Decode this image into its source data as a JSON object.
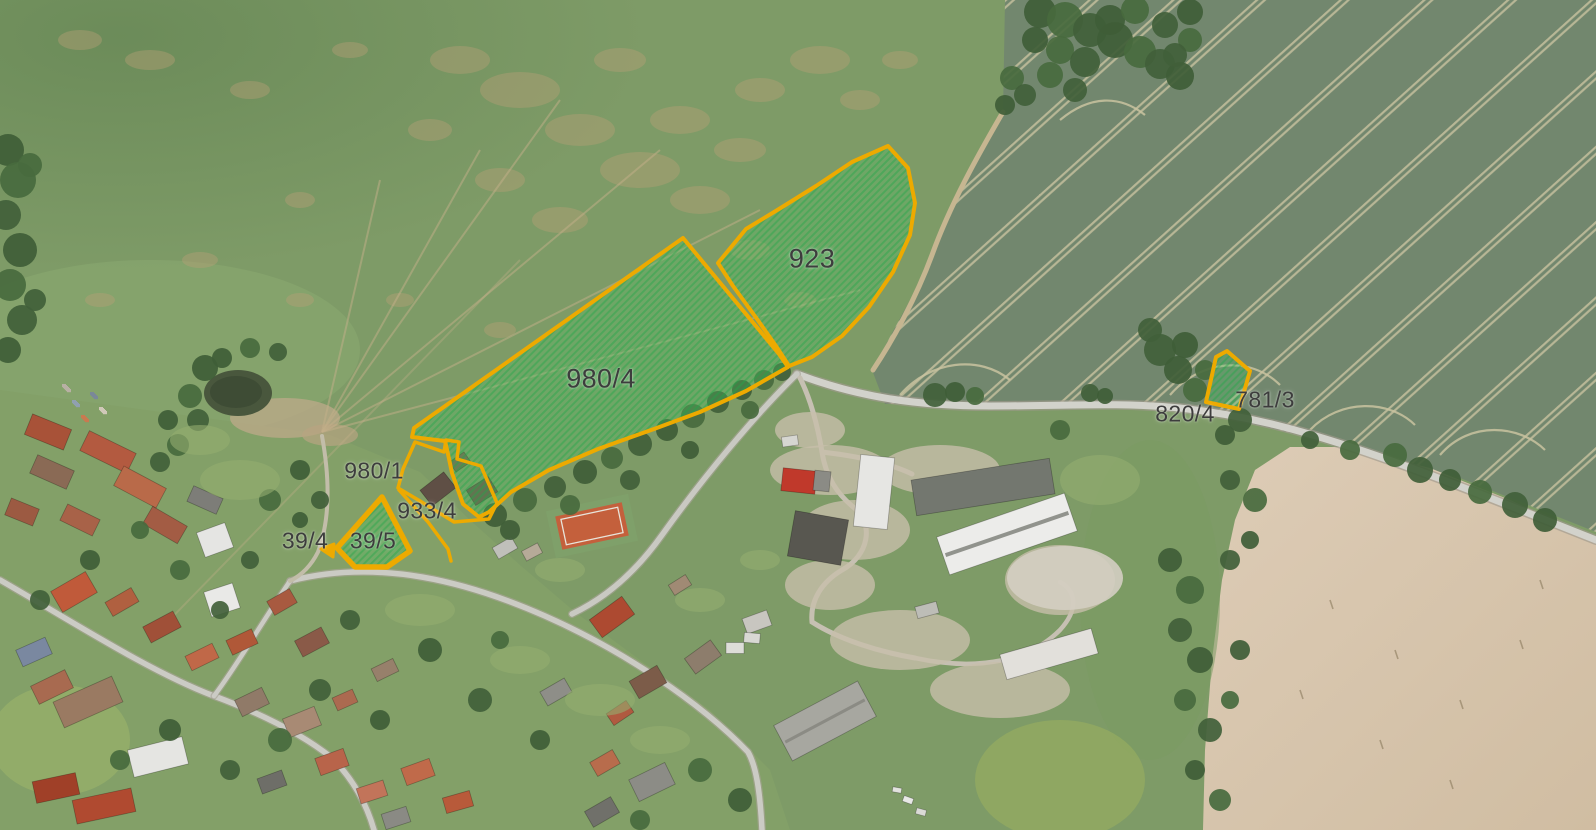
{
  "map": {
    "title": "Aerial cadastral map with highlighted parcels",
    "parcels": [
      {
        "id": "980-4",
        "label": "980/4",
        "highlighted": true
      },
      {
        "id": "923",
        "label": "923",
        "highlighted": true
      },
      {
        "id": "781-3",
        "label": "781/3",
        "highlighted": true
      },
      {
        "id": "39-5",
        "label": "39/5",
        "highlighted": true
      },
      {
        "id": "39-4",
        "label": "39/4",
        "highlighted": true
      },
      {
        "id": "980-1",
        "label": "980/1",
        "highlighted": false
      },
      {
        "id": "933-4",
        "label": "933/4",
        "highlighted": false
      },
      {
        "id": "820-4",
        "label": "820/4",
        "highlighted": false
      }
    ],
    "colors": {
      "parcel_outline": "#edaa00",
      "parcel_highlight_fill": "#3bc05e",
      "label_text": "#3d3d3d"
    }
  }
}
